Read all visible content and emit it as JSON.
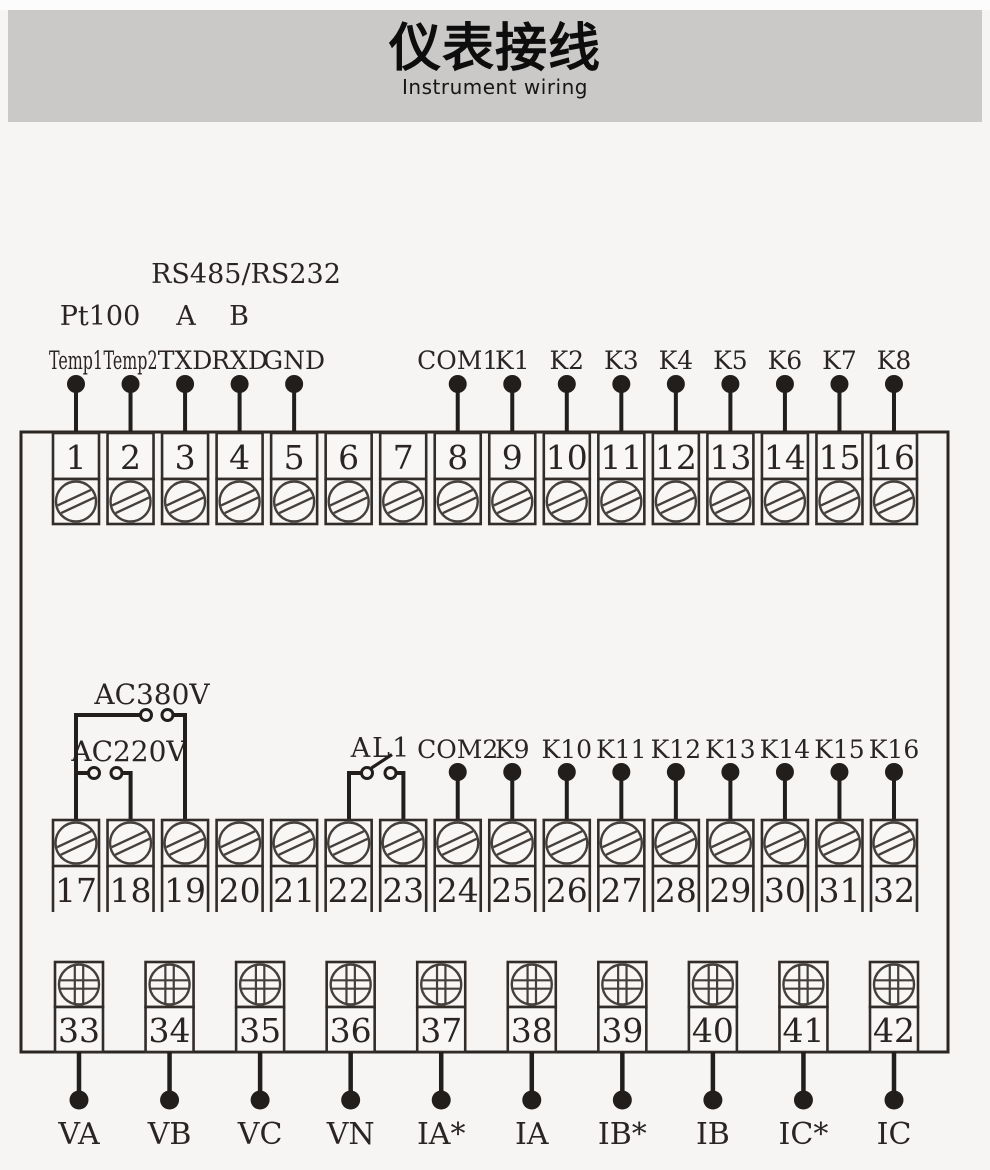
{
  "header": {
    "title": "仪表接线",
    "subtitle": "Instrument wiring"
  },
  "colors": {
    "ink": "#221e1c",
    "box_stroke": "#332d2a",
    "screw_stroke": "#45403c",
    "band": "#cac9c8",
    "page_bg": "#f6f5f4"
  },
  "diagram": {
    "annotations": {
      "pt100": "Pt100",
      "rs": "RS485/RS232",
      "rs_a": "A",
      "rs_b": "B",
      "ac380": "AC380V",
      "ac220": "AC220V",
      "al1": "AL1"
    },
    "top_row": {
      "terminals": [
        {
          "num": "1",
          "label": "Temp1"
        },
        {
          "num": "2",
          "label": "Temp2"
        },
        {
          "num": "3",
          "label": "TXD"
        },
        {
          "num": "4",
          "label": "RXD"
        },
        {
          "num": "5",
          "label": "GND"
        },
        {
          "num": "6",
          "label": ""
        },
        {
          "num": "7",
          "label": ""
        },
        {
          "num": "8",
          "label": "COM1"
        },
        {
          "num": "9",
          "label": "K1"
        },
        {
          "num": "10",
          "label": "K2"
        },
        {
          "num": "11",
          "label": "K3"
        },
        {
          "num": "12",
          "label": "K4"
        },
        {
          "num": "13",
          "label": "K5"
        },
        {
          "num": "14",
          "label": "K6"
        },
        {
          "num": "15",
          "label": "K7"
        },
        {
          "num": "16",
          "label": "K8"
        }
      ]
    },
    "middle_row": {
      "terminals": [
        {
          "num": "17",
          "label": ""
        },
        {
          "num": "18",
          "label": ""
        },
        {
          "num": "19",
          "label": ""
        },
        {
          "num": "20",
          "label": ""
        },
        {
          "num": "21",
          "label": ""
        },
        {
          "num": "22",
          "label": ""
        },
        {
          "num": "23",
          "label": ""
        },
        {
          "num": "24",
          "label": "COM2"
        },
        {
          "num": "25",
          "label": "K9"
        },
        {
          "num": "26",
          "label": "K10"
        },
        {
          "num": "27",
          "label": "K11"
        },
        {
          "num": "28",
          "label": "K12"
        },
        {
          "num": "29",
          "label": "K13"
        },
        {
          "num": "30",
          "label": "K14"
        },
        {
          "num": "31",
          "label": "K15"
        },
        {
          "num": "32",
          "label": "K16"
        }
      ]
    },
    "bottom_row": {
      "terminals": [
        {
          "num": "33",
          "label": "VA"
        },
        {
          "num": "34",
          "label": "VB"
        },
        {
          "num": "35",
          "label": "VC"
        },
        {
          "num": "36",
          "label": "VN"
        },
        {
          "num": "37",
          "label": "IA*"
        },
        {
          "num": "38",
          "label": "IA"
        },
        {
          "num": "39",
          "label": "IB*"
        },
        {
          "num": "40",
          "label": "IB"
        },
        {
          "num": "41",
          "label": "IC*"
        },
        {
          "num": "42",
          "label": "IC"
        }
      ]
    }
  }
}
